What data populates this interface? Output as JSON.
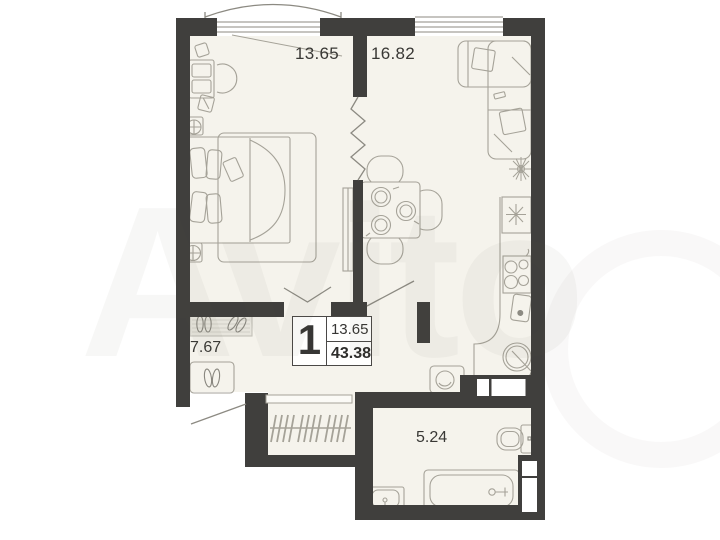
{
  "plan": {
    "unit": {
      "rooms_count": "1",
      "living_area": "13.65",
      "total_area": "43.38"
    },
    "areas": {
      "bedroom": "13.65",
      "living_kitchen": "16.82",
      "hallway": "7.67",
      "bathroom": "5.24"
    },
    "furniture": [
      "bed",
      "desk",
      "desk-chair",
      "nightstand-lamps",
      "rug",
      "wardrobe",
      "corner-sofa",
      "plant",
      "dining-table",
      "chairs",
      "fridge",
      "stove",
      "cutting-board",
      "kitchen-sink",
      "washing-machine",
      "doormat",
      "shoes",
      "shoe-cabinet",
      "hanger-rail",
      "toilet",
      "bathtub",
      "bathroom-sink"
    ]
  },
  "watermark": {
    "text": "Avito"
  },
  "colors": {
    "wall": "#403f3d",
    "floor": "#f5f3ec",
    "line": "#a5a298",
    "door_line": "#8c8a82"
  }
}
